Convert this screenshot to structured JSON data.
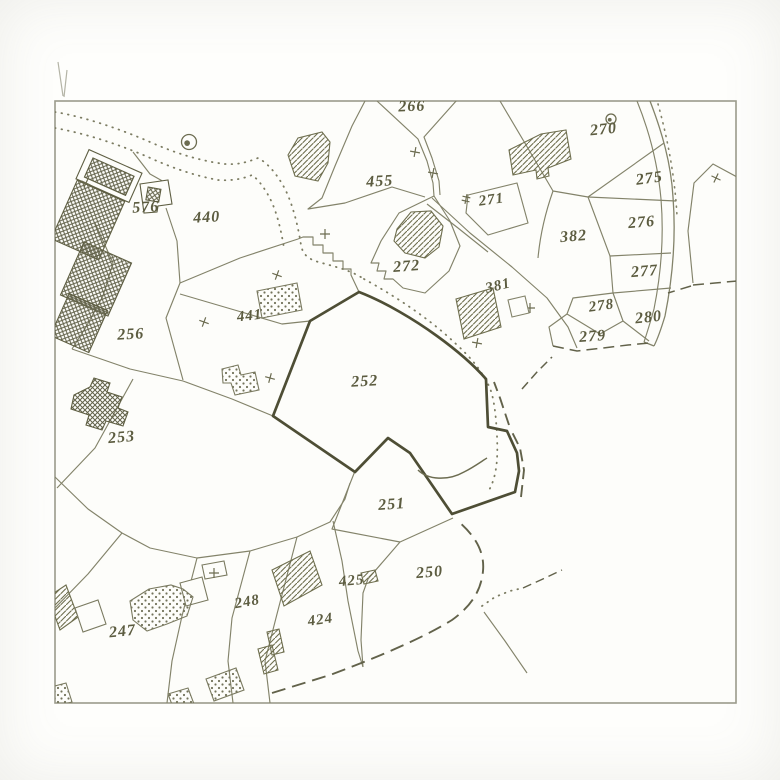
{
  "map_sheet": {
    "type": "cadastral-parcel-map",
    "highlighted_parcel": "252",
    "colors": {
      "thin_line": "#83836a",
      "bold_line": "#4e4e35",
      "label": "#5c5c40",
      "hatch": "#6e6e4e",
      "stipple": "#73735a",
      "frame": "#9b9b8b",
      "paper": "#fdfdfa"
    },
    "parcels": [
      {
        "label": "266",
        "x": 412,
        "y": 111,
        "rot": -2,
        "size": 16
      },
      {
        "label": "270",
        "x": 604,
        "y": 134,
        "rot": -6,
        "size": 16
      },
      {
        "label": "455",
        "x": 380,
        "y": 186,
        "rot": -3,
        "size": 16
      },
      {
        "label": "576",
        "x": 146,
        "y": 212,
        "rot": -3,
        "size": 16
      },
      {
        "label": "440",
        "x": 207,
        "y": 222,
        "rot": -3,
        "size": 16
      },
      {
        "label": "271",
        "x": 492,
        "y": 204,
        "rot": -8,
        "size": 15
      },
      {
        "label": "382",
        "x": 574,
        "y": 241,
        "rot": -5,
        "size": 16
      },
      {
        "label": "275",
        "x": 650,
        "y": 183,
        "rot": -8,
        "size": 16
      },
      {
        "label": "276",
        "x": 642,
        "y": 227,
        "rot": -5,
        "size": 16
      },
      {
        "label": "272",
        "x": 407,
        "y": 271,
        "rot": -4,
        "size": 16
      },
      {
        "label": "277",
        "x": 645,
        "y": 276,
        "rot": -5,
        "size": 16
      },
      {
        "label": "381",
        "x": 499,
        "y": 290,
        "rot": -13,
        "size": 15
      },
      {
        "label": "278",
        "x": 602,
        "y": 310,
        "rot": -8,
        "size": 15
      },
      {
        "label": "280",
        "x": 649,
        "y": 322,
        "rot": -6,
        "size": 16
      },
      {
        "label": "279",
        "x": 593,
        "y": 341,
        "rot": -4,
        "size": 16
      },
      {
        "label": "441",
        "x": 250,
        "y": 320,
        "rot": -6,
        "size": 15
      },
      {
        "label": "256",
        "x": 131,
        "y": 339,
        "rot": -3,
        "size": 16
      },
      {
        "label": "252",
        "x": 365,
        "y": 386,
        "rot": -3,
        "size": 16
      },
      {
        "label": "253",
        "x": 122,
        "y": 442,
        "rot": -5,
        "size": 16
      },
      {
        "label": "251",
        "x": 392,
        "y": 509,
        "rot": -4,
        "size": 16
      },
      {
        "label": "425",
        "x": 352,
        "y": 585,
        "rot": -5,
        "size": 15
      },
      {
        "label": "250",
        "x": 430,
        "y": 577,
        "rot": -5,
        "size": 16
      },
      {
        "label": "248",
        "x": 248,
        "y": 606,
        "rot": -10,
        "size": 15
      },
      {
        "label": "424",
        "x": 321,
        "y": 624,
        "rot": -8,
        "size": 15
      },
      {
        "label": "247",
        "x": 123,
        "y": 636,
        "rot": -6,
        "size": 16
      }
    ],
    "symbols": [
      {
        "name": "well-circle",
        "x": 189,
        "y": 142,
        "r": 7.5
      },
      {
        "name": "well-circle",
        "x": 611,
        "y": 119,
        "r": 5
      }
    ]
  }
}
